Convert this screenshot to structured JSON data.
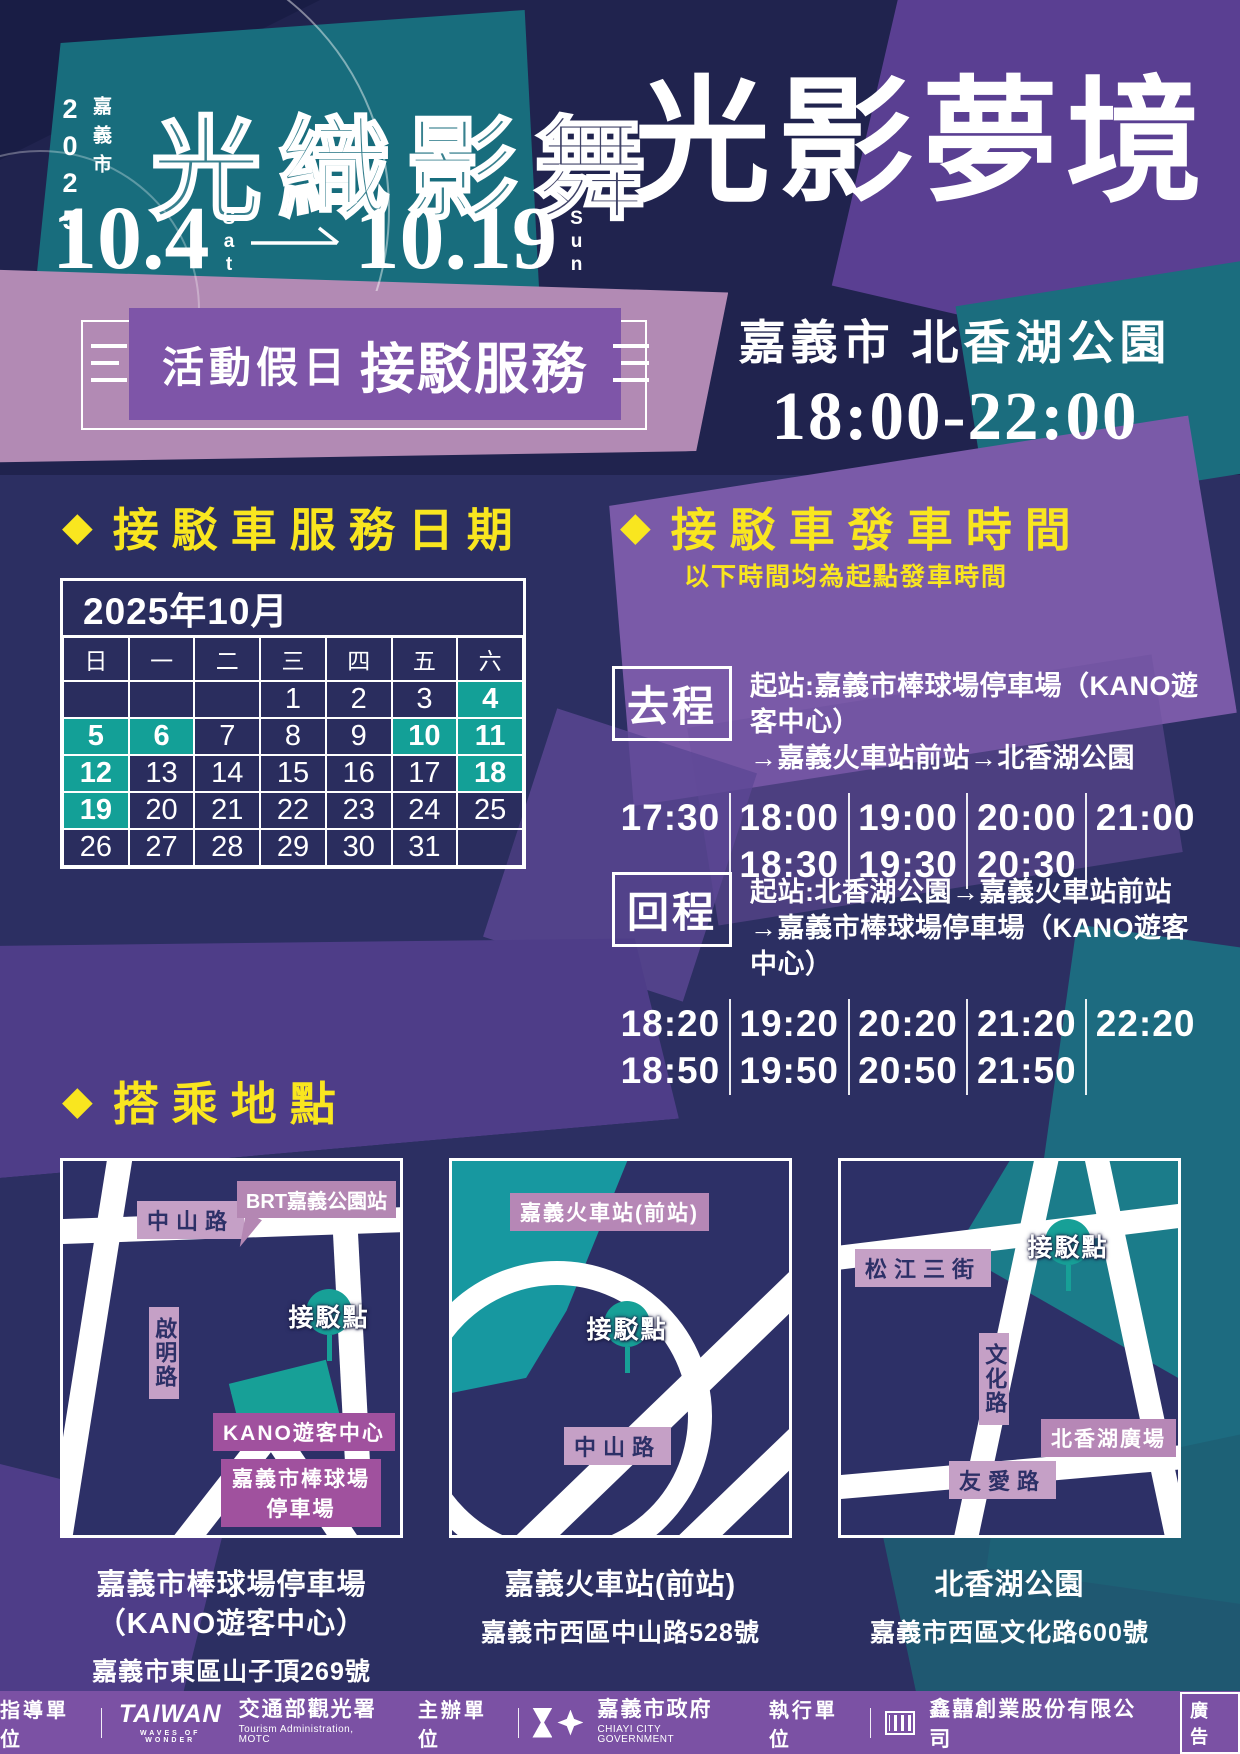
{
  "icons": {
    "diamond": "◆"
  },
  "colors": {
    "bg_navy": "#2c2f62",
    "header_navy": "#20234e",
    "accent_yellow": "#f9e61f",
    "highlight_teal": "#13a097",
    "banner_purple": "#7e55a8",
    "footer_purple": "#7b51a4",
    "mauve": "#b28ab4",
    "map_label_light": "#c5a0c6",
    "map_label_purple": "#a0519e",
    "teal_shape": "#186d7d"
  },
  "header": {
    "year": "2025",
    "city": "嘉義市",
    "festival_title": "光織影舞",
    "date_start": "10.4",
    "date_start_day": "Sat",
    "date_end": "10.19",
    "date_end_day": "Sun",
    "main_title": "光影夢境"
  },
  "banner": {
    "label_regular": "活動假日",
    "label_bold": "接駁服務"
  },
  "venue": {
    "location": "嘉義市 北香湖公園",
    "hours": "18:00-22:00"
  },
  "calendar_section": {
    "heading": "接駁車服務日期",
    "month_title": "2025年10月",
    "weekdays": [
      "日",
      "一",
      "二",
      "三",
      "四",
      "五",
      "六"
    ],
    "weeks": [
      [
        "",
        "",
        "",
        "1",
        "2",
        "3",
        "4"
      ],
      [
        "5",
        "6",
        "7",
        "8",
        "9",
        "10",
        "11"
      ],
      [
        "12",
        "13",
        "14",
        "15",
        "16",
        "17",
        "18"
      ],
      [
        "19",
        "20",
        "21",
        "22",
        "23",
        "24",
        "25"
      ],
      [
        "26",
        "27",
        "28",
        "29",
        "30",
        "31",
        ""
      ]
    ],
    "highlighted_days": [
      "4",
      "5",
      "6",
      "10",
      "11",
      "12",
      "18",
      "19"
    ]
  },
  "times_section": {
    "heading": "接駁車發車時間",
    "subtitle": "以下時間均為起點發車時間",
    "outbound": {
      "label": "去程",
      "route_line1": "起站:嘉義市棒球場停車場（KANO遊客中心）",
      "route_line2": "→嘉義火車站前站→北香湖公園",
      "columns": [
        [
          "17:30"
        ],
        [
          "18:00",
          "18:30"
        ],
        [
          "19:00",
          "19:30"
        ],
        [
          "20:00",
          "20:30"
        ],
        [
          "21:00"
        ]
      ]
    },
    "return_trip": {
      "label": "回程",
      "route_line1": "起站:北香湖公園→嘉義火車站前站",
      "route_line2": "→嘉義市棒球場停車場（KANO遊客中心）",
      "columns": [
        [
          "18:20",
          "18:50"
        ],
        [
          "19:20",
          "19:50"
        ],
        [
          "20:20",
          "20:50"
        ],
        [
          "21:20",
          "21:50"
        ],
        [
          "22:20"
        ]
      ]
    }
  },
  "locations_section": {
    "heading": "搭乘地點",
    "maps": [
      {
        "road_top": "中山路",
        "callout": "BRT嘉義公園站",
        "road_left": "啟明路",
        "pin": "接駁點",
        "building": "KANO遊客中心",
        "area": "嘉義市棒球場 停車場",
        "caption": {
          "title_lines": [
            "嘉義市棒球場停車場",
            "（KANO遊客中心）"
          ],
          "address": "嘉義市東區山子頂269號"
        }
      },
      {
        "station": "嘉義火車站(前站)",
        "pin": "接駁點",
        "road_bottom": "中山路",
        "caption": {
          "title_lines": [
            "嘉義火車站(前站)"
          ],
          "address": "嘉義市西區中山路528號"
        }
      },
      {
        "road_top": "松江三街",
        "pin": "接駁點",
        "road_mid": "文化路",
        "plaza": "北香湖廣場",
        "road_bottom": "友愛路",
        "caption": {
          "title_lines": [
            "北香湖公園"
          ],
          "address": "嘉義市西區文化路600號"
        }
      }
    ]
  },
  "footer": {
    "group1": {
      "role": "指導單位",
      "logo_word": "TAIWAN",
      "logo_sub": "WAVES OF WONDER",
      "org": "交通部觀光署",
      "org_sub": "Tourism Administration, MOTC"
    },
    "group2": {
      "role": "主辦單位",
      "org": "嘉義市政府",
      "org_sub": "CHIAYI CITY GOVERNMENT"
    },
    "group3": {
      "role": "執行單位",
      "org": "鑫囍創業股份有限公司"
    },
    "ad_label": "廣告"
  }
}
